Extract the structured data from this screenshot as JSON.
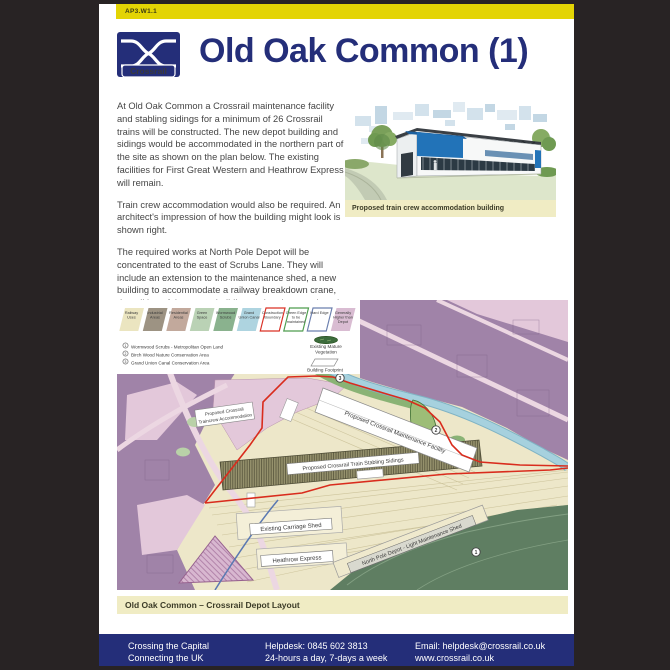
{
  "header": {
    "code": "AP3.W1.1"
  },
  "logo": {
    "brand": "Crossrail"
  },
  "title": "Old Oak Common (1)",
  "paragraphs": {
    "p1": "At Old Oak Common a Crossrail maintenance facility and stabling sidings for a minimum of 26 Crossrail trains will be constructed. The new depot building and sidings would be accommodated in the northern part of the site as shown on the plan below. The existing facilities for First Great Western and Heathrow Express will remain.",
    "p2": "Train crew accommodation would also be required. An architect's impression of how the building might look is shown right.",
    "p3": "The required works at North Pole Depot will be concentrated to the east of Scrubs Lane. They will include an extension to the maintenance shed, a new building to accommodate a railway breakdown crane, demolition of the stores building and various track and internal roadway alterations."
  },
  "impression": {
    "caption": "Proposed train crew accommodation building"
  },
  "map": {
    "caption": "Old Oak Common – Crossrail Depot Layout",
    "legend": {
      "swatches": [
        {
          "lines": [
            "Railway",
            "Uses",
            ""
          ],
          "fill": "#ebe5c0",
          "stroke": "none"
        },
        {
          "lines": [
            "Industrial",
            "Areas",
            ""
          ],
          "fill": "#9d9383",
          "stroke": "none"
        },
        {
          "lines": [
            "Residential",
            "Areas",
            ""
          ],
          "fill": "#c2a99c",
          "stroke": "none"
        },
        {
          "lines": [
            "Green",
            "Space",
            ""
          ],
          "fill": "#bad2b5",
          "stroke": "none"
        },
        {
          "lines": [
            "Wormwood",
            "Scrubs",
            ""
          ],
          "fill": "#8ab28e",
          "stroke": "none"
        },
        {
          "lines": [
            "Grand",
            "Union Canal",
            ""
          ],
          "fill": "#aed4e0",
          "stroke": "none"
        },
        {
          "lines": [
            "Construction",
            "Boundary",
            ""
          ],
          "fill": "#ffffff",
          "stroke": "#d93025"
        },
        {
          "lines": [
            "Green Edge",
            "to be",
            "maintained"
          ],
          "fill": "#ffffff",
          "stroke": "#4e9c4e"
        },
        {
          "lines": [
            "Hard Edge",
            "",
            ""
          ],
          "fill": "#ffffff",
          "stroke": "#6b7fae"
        },
        {
          "lines": [
            "Generally",
            "Higher than",
            "Depot"
          ],
          "fill": "#d9bcd2",
          "stroke": "none"
        }
      ],
      "vegetation": [
        "Existing Mature",
        "Vegetation"
      ],
      "footprint": "Building Footprint",
      "numbered": [
        {
          "num": "1",
          "label": "Wormwood Scrubs - Metropolitan Open Land"
        },
        {
          "num": "2",
          "label": "Birch Wood Nature Conservation Area"
        },
        {
          "num": "3",
          "label": "Grand Union Canal Conservation Area"
        }
      ]
    },
    "labels": {
      "maintenance_facility": "Proposed Crossrail Maintenance Facility",
      "stabling_sidings": "Proposed Crossrail Train Stabling Sidings",
      "traincrew": [
        "Proposed Crossrail",
        "Traincrew Accommodation"
      ],
      "carriage_shed": "Existing Carriage Shed",
      "heathrow_express": "Heathrow Express",
      "north_pole": "North Pole Depot - Light Maintenance Shed"
    },
    "markers": {
      "m1": "1",
      "m2": "2",
      "m3": "3"
    }
  },
  "footer": {
    "col1": [
      "Crossing the Capital",
      "Connecting the UK"
    ],
    "col2": [
      "Helpdesk: 0845 602 3813",
      "24-hours a day, 7-days a week"
    ],
    "col3": [
      "Email: helpdesk@crossrail.co.uk",
      "www.crossrail.co.uk"
    ]
  },
  "colors": {
    "band_yellow": "#e3d404",
    "navy": "#242e79",
    "caption_bg": "#f0ecc4",
    "boundary_red": "#d92c1d",
    "canal_blue": "#a6d1de",
    "higher_purple": "#a083a8",
    "scrubs_green": "#5f7e62",
    "frame_bg": "#282324"
  }
}
